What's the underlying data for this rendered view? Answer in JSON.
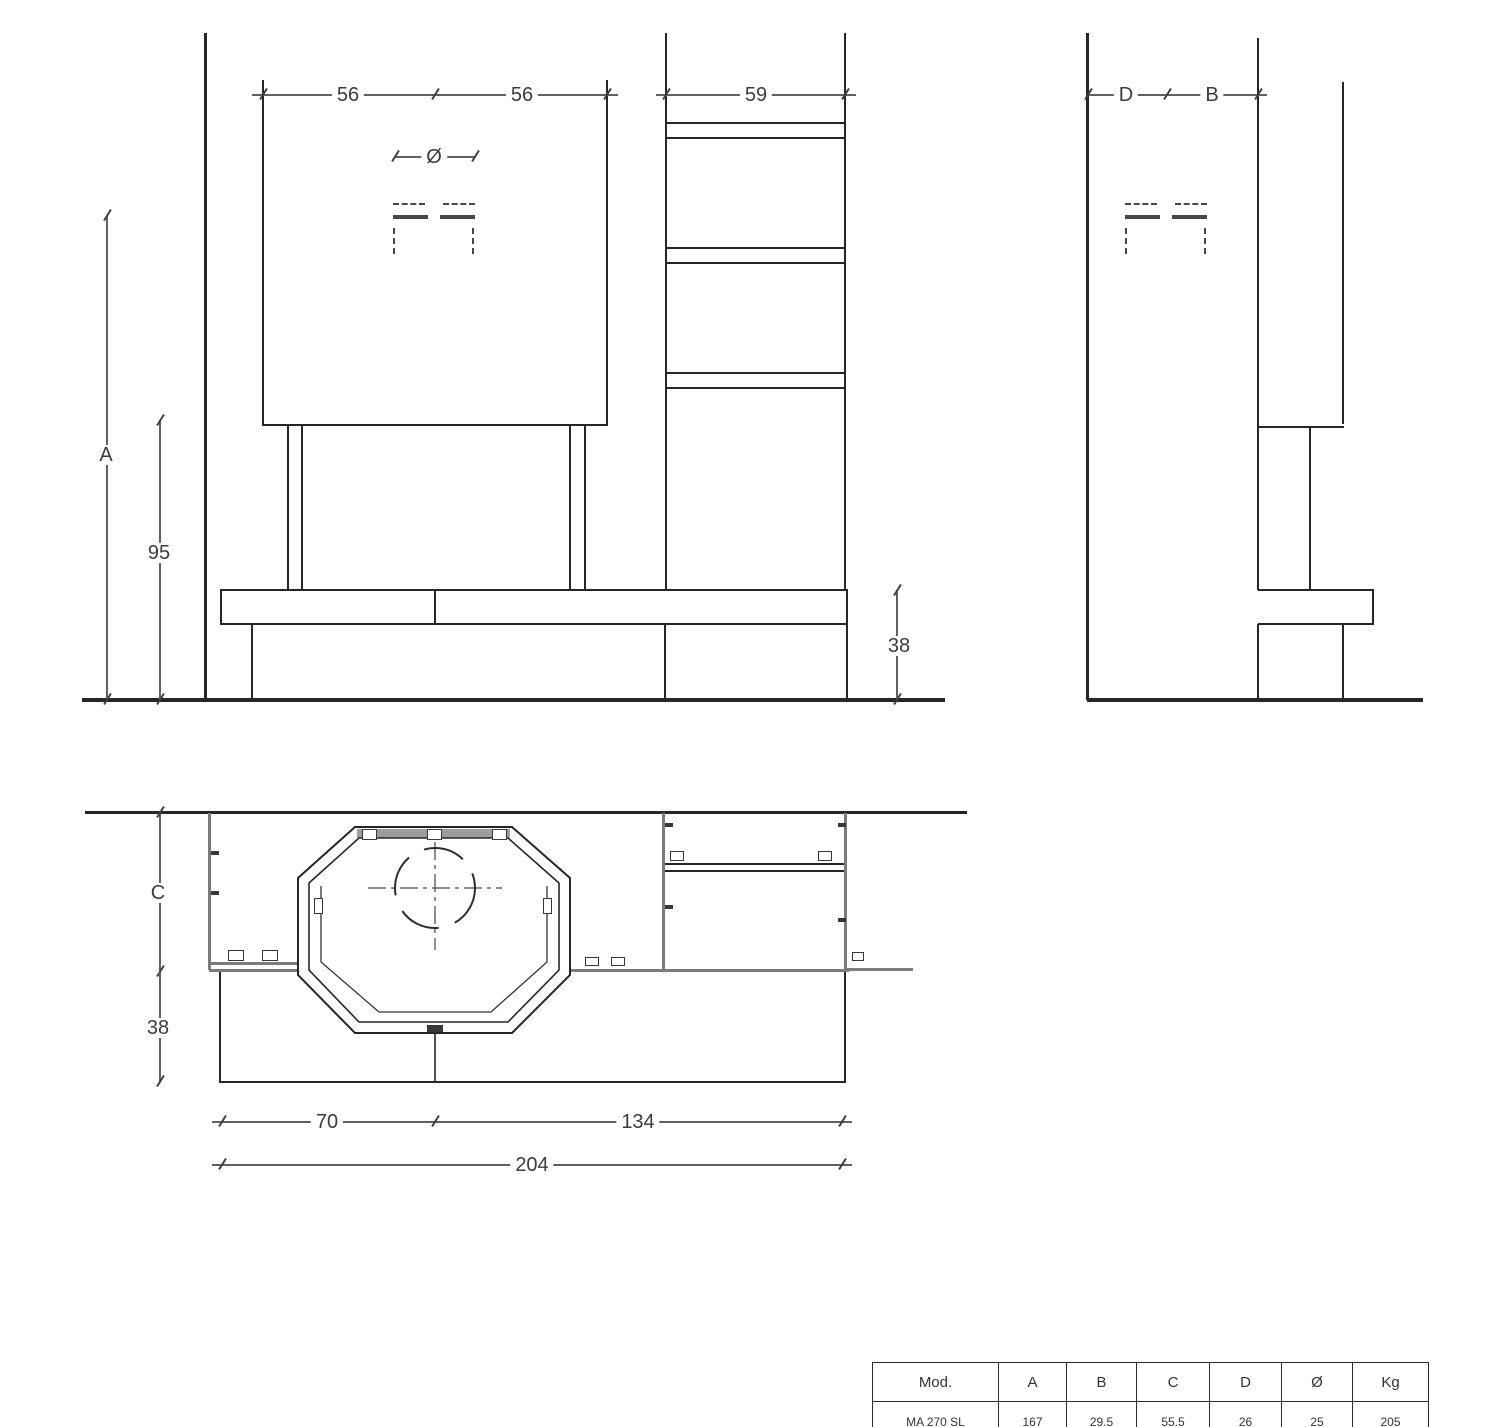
{
  "front_view": {
    "dim_firebox_half_left": "56",
    "dim_firebox_half_right": "56",
    "dim_shelf_column_width": "59",
    "dim_flue_diameter_symbol": "Ø",
    "dim_total_height": "A",
    "dim_hearth_height": "95",
    "dim_bench_height": "38"
  },
  "side_view": {
    "dim_flue_to_wall": "D",
    "dim_flue_to_front": "B"
  },
  "plan_view": {
    "dim_body_depth": "C",
    "dim_bench_depth": "38",
    "dim_left_section": "70",
    "dim_right_section": "134",
    "dim_total_width": "204"
  },
  "spec_table": {
    "headers": [
      "Mod.",
      "A",
      "B",
      "C",
      "D",
      "Ø",
      "Kg"
    ],
    "rows": [
      [
        "MA 270 SL",
        "167",
        "29.5",
        "55.5",
        "26",
        "25",
        "205"
      ]
    ]
  },
  "colors": {
    "line": "#262626",
    "dimension": "#606060",
    "gray_part": "#7b7b7b",
    "top_band": "#9c9c9c"
  }
}
